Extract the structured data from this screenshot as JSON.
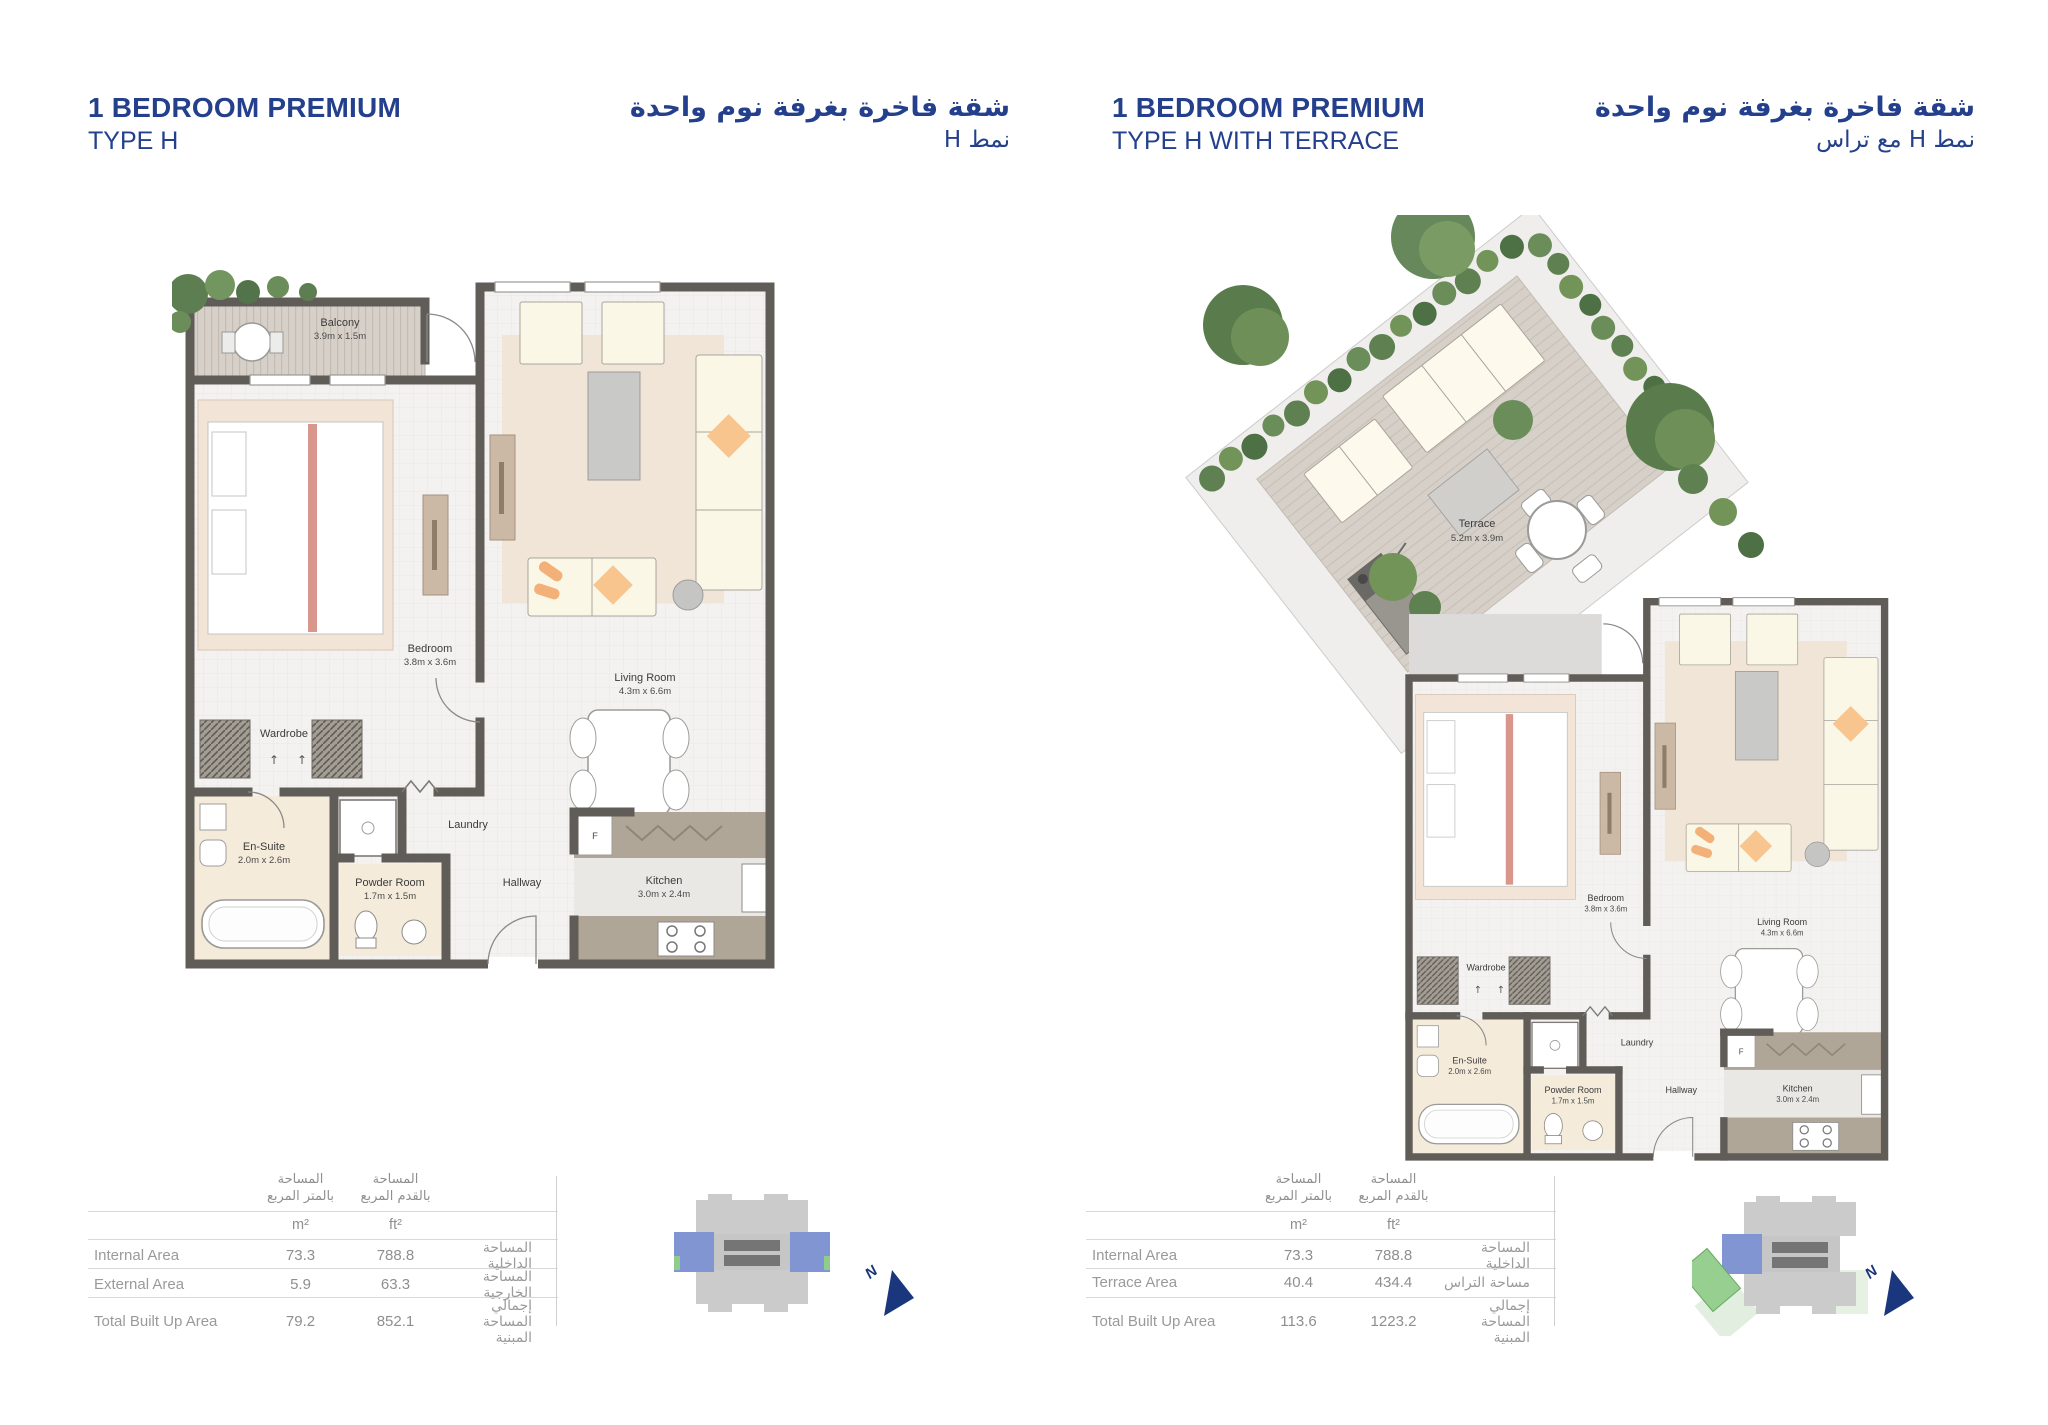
{
  "colors": {
    "title_blue": "#24408c",
    "navy_arrow": "#1a367d",
    "unit_blue": "#8095d2",
    "terrace_green": "#97cf90",
    "wall_gray": "#605c58"
  },
  "left_panel": {
    "title_line1": "1 BEDROOM PREMIUM",
    "title_line2": "TYPE H",
    "title_ar_line1": "شقة فاخرة بغرفة نوم واحدة",
    "title_ar_line2": "نمط H",
    "north": "N",
    "table": {
      "rows": [
        {
          "label_en": "Internal Area",
          "m2": "73.3",
          "ft2": "788.8",
          "label_ar": "المساحة الداخلية"
        },
        {
          "label_en": "External Area",
          "m2": "5.9",
          "ft2": "63.3",
          "label_ar": "المساحة الخارجية"
        },
        {
          "label_en": "Total Built Up Area",
          "m2": "79.2",
          "ft2": "852.1",
          "label_ar": "إجمالي المساحة المبنية"
        }
      ]
    }
  },
  "right_panel": {
    "title_line1": "1 BEDROOM PREMIUM",
    "title_line2": "TYPE H WITH TERRACE",
    "title_ar_line1": "شقة فاخرة بغرفة نوم واحدة",
    "title_ar_line2": "نمط H مع تراس",
    "north": "N",
    "table": {
      "rows": [
        {
          "label_en": "Internal Area",
          "m2": "73.3",
          "ft2": "788.8",
          "label_ar": "المساحة الداخلية"
        },
        {
          "label_en": "Terrace Area",
          "m2": "40.4",
          "ft2": "434.4",
          "label_ar": "مساحة التراس"
        },
        {
          "label_en": "Total Built Up Area",
          "m2": "113.6",
          "ft2": "1223.2",
          "label_ar": "إجمالي المساحة المبنية"
        }
      ]
    }
  },
  "table_shared": {
    "header_m2_l1": "المساحة",
    "header_m2_l2": "بالمتر المربع",
    "header_ft2_l1": "المساحة",
    "header_ft2_l2": "بالقدم المربع",
    "unit_m": "m²",
    "unit_ft": "ft²"
  },
  "rooms": {
    "balcony": {
      "name": "Balcony",
      "dim": "3.9m x 1.5m"
    },
    "terrace": {
      "name": "Terrace",
      "dim": "5.2m x 3.9m"
    },
    "bedroom": {
      "name": "Bedroom",
      "dim": "3.8m x 3.6m"
    },
    "living": {
      "name": "Living Room",
      "dim": "4.3m x 6.6m"
    },
    "wardrobe": {
      "name": "Wardrobe"
    },
    "ensuite": {
      "name": "En-Suite",
      "dim": "2.0m x 2.6m"
    },
    "laundry": {
      "name": "Laundry"
    },
    "powder": {
      "name": "Powder Room",
      "dim": "1.7m x 1.5m"
    },
    "hallway": {
      "name": "Hallway"
    },
    "kitchen": {
      "name": "Kitchen",
      "dim": "3.0m x 2.4m"
    },
    "fridge": "F",
    "wardrobe_arrow": "↑"
  }
}
